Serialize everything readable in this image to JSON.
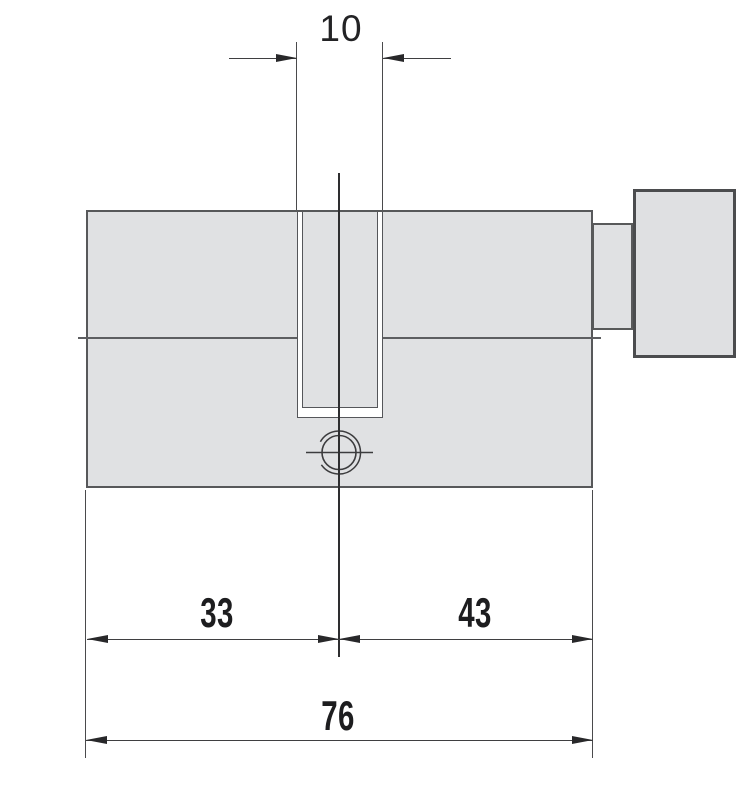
{
  "drawing": {
    "type": "technical-dimension-drawing",
    "subject": "profile-lock-cylinder-with-thumbturn",
    "units_shown": "none (bare numbers, mm implied)",
    "dimensions": {
      "keyway_width": "10",
      "segment_a": "33",
      "segment_b": "43",
      "total_length": "76"
    },
    "colors": {
      "background": "#ffffff",
      "body_fill": "#e0e1e3",
      "body_border": "#57585a",
      "knob_border": "#4b4c4e",
      "dimension_line": "#3f3f41",
      "arrow": "#28282a",
      "text": "#1d1d1f"
    }
  }
}
